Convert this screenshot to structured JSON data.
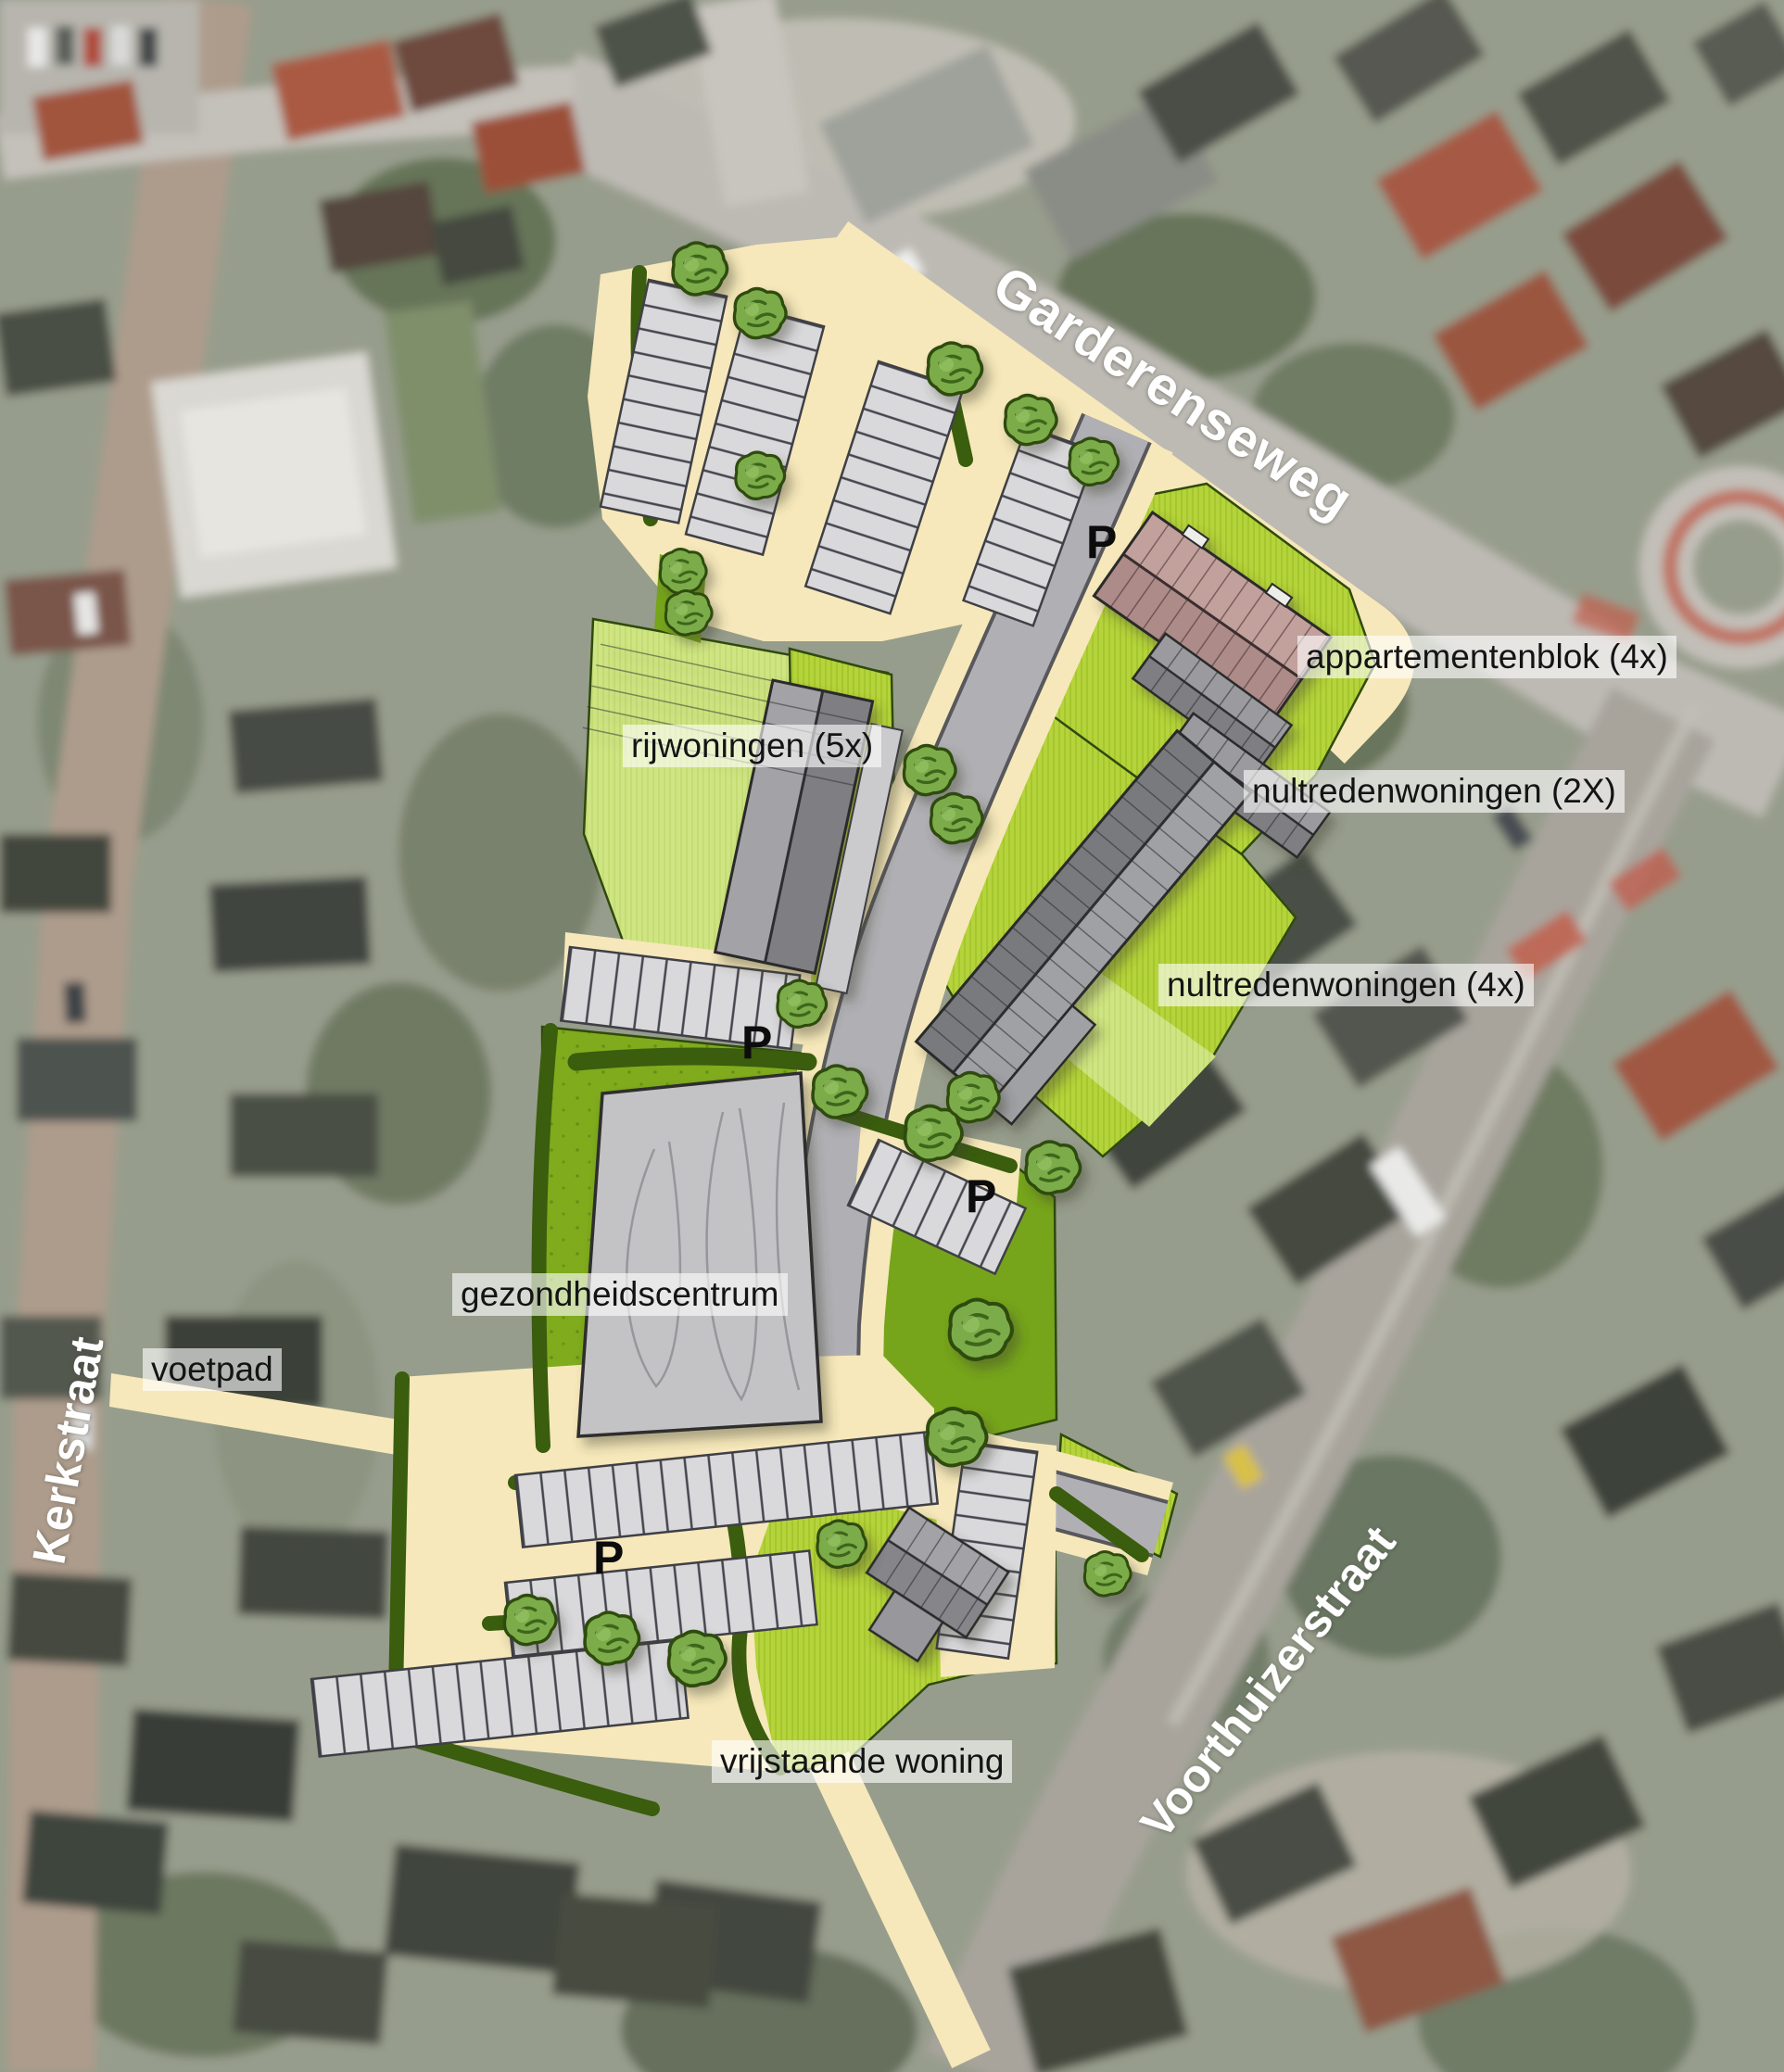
{
  "plan": {
    "streets": {
      "garderenseweg": "Garderenseweg",
      "kerkstraat": "Kerkstraat",
      "voorthuizerstraat": "Voorthuizerstraat"
    },
    "features": {
      "voetpad": "voetpad",
      "rijwoningen": "rijwoningen (5x)",
      "appartementenblok": "appartementenblok (4x)",
      "nultredenwoningen_2x": "nultredenwoningen (2X)",
      "nultredenwoningen_4x": "nultredenwoningen (4x)",
      "gezondheidscentrum": "gezondheidscentrum",
      "vrijstaande_woning": "vrijstaande woning"
    },
    "parking_symbol": "P",
    "colors": {
      "path_cream": "#F6E8BA",
      "road_gray": "#B0B0B4",
      "road_edge": "#58585C",
      "parcel_lime": "#B5D33B",
      "garden_lime": "#CFE483",
      "green_mid": "#76A51B",
      "hedge_dark": "#3A5D0E",
      "tree_green": "#7CAC49",
      "roof_gray_light": "#A0A1A5",
      "roof_gray_dark": "#797A7E",
      "apartment_mauve": "#AD8B89",
      "health_center_gray": "#C3C3C6",
      "label_text": "#141414",
      "street_text": "#FFFFFF"
    }
  }
}
